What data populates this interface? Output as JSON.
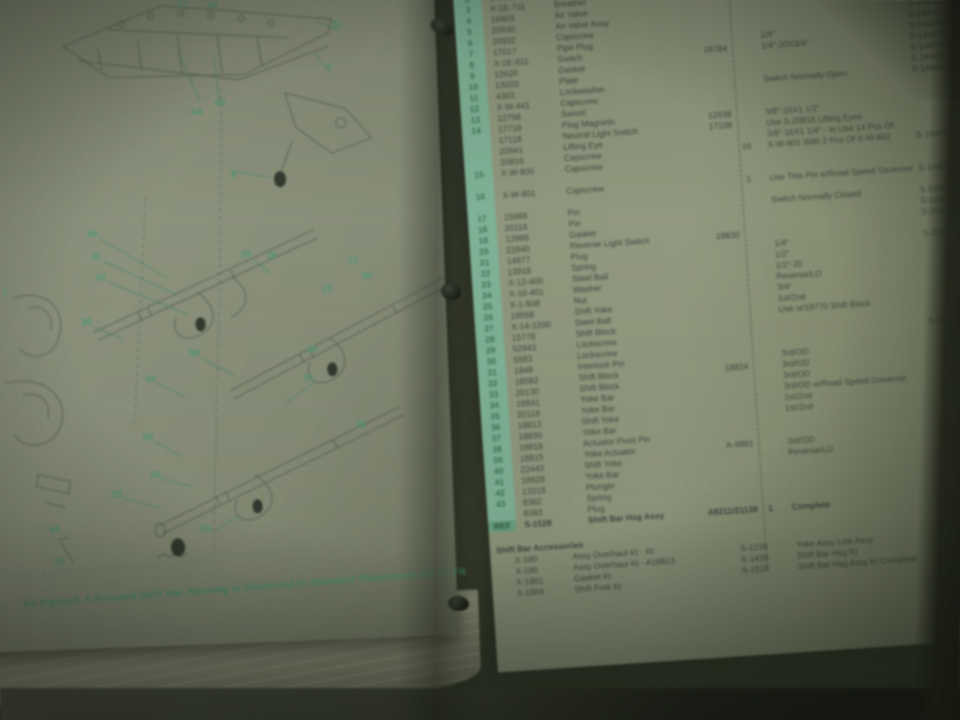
{
  "photo_subject": "Open ring binder showing a transmission shift bar housing parts manual",
  "colors": {
    "page": "#91997c",
    "background": "#343a2b",
    "mint_band": "#79bf9a",
    "accent_green": "#43a173",
    "ink": "#39443a"
  },
  "left_page": {
    "caption_small": "S-1528 CPL SHIFT BAR HOUSING ASSEMBLY",
    "caption_main": "As Figured: A Forward Shift Bar Housing Is Illustrated In Standard Placements Kit To Fit",
    "callouts": [
      [
        "1",
        38,
        34
      ],
      [
        "21",
        222,
        28
      ],
      [
        "24",
        252,
        30
      ],
      [
        "11",
        376,
        54
      ],
      [
        "4",
        366,
        96
      ],
      [
        "64",
        232,
        136
      ],
      [
        "63",
        256,
        128
      ],
      [
        "8",
        267,
        200
      ],
      [
        "7",
        34,
        310
      ],
      [
        "40",
        123,
        254
      ],
      [
        "41",
        126,
        277
      ],
      [
        "42",
        130,
        298
      ],
      [
        "20",
        276,
        280
      ],
      [
        "26",
        302,
        282
      ],
      [
        "27",
        356,
        318
      ],
      [
        "17",
        383,
        291
      ],
      [
        "36",
        396,
        306
      ],
      [
        "35",
        114,
        342
      ],
      [
        "38",
        220,
        377
      ],
      [
        "34",
        176,
        401
      ],
      [
        "30",
        338,
        378
      ],
      [
        "31",
        334,
        406
      ],
      [
        "29",
        171,
        459
      ],
      [
        "28",
        384,
        455
      ],
      [
        "33",
        177,
        497
      ],
      [
        "32",
        138,
        515
      ],
      [
        "25",
        225,
        553
      ],
      [
        "43",
        74,
        548
      ],
      [
        "23",
        78,
        580
      ]
    ]
  },
  "right_page": {
    "rows": [
      [
        "",
        "",
        "Shift Bar Hsg",
        "A8211/21138 Assy",
        "",
        "",
        ""
      ],
      [
        "1",
        "X-1-110",
        "Socket",
        "",
        "",
        "",
        "S-1528"
      ],
      [
        "2",
        "14012",
        "Pipe Plug",
        "18828",
        "",
        "1/4\"-20X1 1/2\"",
        "S-2081/S-1440/S-1528"
      ],
      [
        "3",
        "X-1E-711",
        "Breather",
        "14117",
        "",
        "3/8\"",
        "S-1440/S-1528"
      ],
      [
        "4",
        "16903",
        "Air Valve",
        "",
        "",
        "",
        "S-1440/S-1528"
      ],
      [
        "5",
        "20930",
        "Air Valve Assy",
        "",
        "",
        "",
        "S-1440/S-1528"
      ],
      [
        "6",
        "20932",
        "Capscrew",
        "",
        "",
        "",
        "S-1440/S-1528"
      ],
      [
        "7",
        "17017",
        "Pipe Plug",
        "",
        "",
        "1/4\"",
        "S-1440/S-1528"
      ],
      [
        "8",
        "X-1E-811",
        "Switch",
        "18784",
        "",
        "1/4\"-20X3/4\"",
        "S-1440/S-1528"
      ],
      [
        "9",
        "12620",
        "Gasket",
        "",
        "",
        "",
        "S-1440/S-1528"
      ],
      [
        "10",
        "13033",
        "Plate",
        "",
        "",
        "",
        "S-1440/S-1528"
      ],
      [
        "11",
        "4303",
        "Lockwasher",
        "",
        "",
        "Switch Normally Open",
        "S-1440/S-1528"
      ],
      [
        "12",
        "X-W-441",
        "Capscrew",
        "",
        "",
        "",
        ""
      ],
      [
        "13",
        "12798",
        "Swivel",
        "",
        "",
        "",
        ""
      ],
      [
        "14",
        "17718",
        "Plug Magnetic",
        "12638",
        "",
        "3/8\"-16X1 1/2\"",
        ""
      ],
      [
        "",
        "17118",
        "Neutral Light Switch",
        "17108",
        "",
        "Use S-20816 Lifting Eyes",
        ""
      ],
      [
        "",
        "20941",
        "Lifting Eye",
        "",
        "",
        "3/8\"-16X1 1/4\" - to Use 14 Pcs Of",
        ""
      ],
      [
        "",
        "20816",
        "Capscrew",
        "",
        "16",
        "X-W-801 With 2 Pcs Of X-W-802",
        "S-1440/S-1528"
      ],
      [
        "15",
        "X-W-800",
        "Capscrew",
        "",
        "",
        "",
        ""
      ],
      [
        "",
        "",
        "",
        "",
        "",
        "",
        ""
      ],
      [
        "16",
        "X-W-801",
        "Capscrew",
        "",
        "1",
        "Use This Pin w/Road Speed Governor",
        "S-1440/S-1528"
      ],
      [
        "",
        "",
        "",
        "",
        "",
        "",
        ""
      ],
      [
        "17",
        "15988",
        "Pin",
        "",
        "",
        "Switch Normally Closed",
        "S-1440/S-1528"
      ],
      [
        "18",
        "20118",
        "Pin",
        "",
        "",
        "",
        "S-1081/S-1440"
      ],
      [
        "19",
        "12988",
        "Gasket",
        "",
        "",
        "",
        "S-2084/S-1528"
      ],
      [
        "20",
        "22840",
        "Reverse Light Switch",
        "18830",
        "",
        "",
        "S-1528"
      ],
      [
        "21",
        "14877",
        "Plug",
        "",
        "",
        "1/4\"",
        "S-2084/S-1528"
      ],
      [
        "22",
        "13918",
        "Spring",
        "",
        "",
        "1/2\"",
        "S-1528"
      ],
      [
        "23",
        "X-12-400",
        "Steel Ball",
        "",
        "",
        "1/2\"-20",
        "S-1528"
      ],
      [
        "24",
        "X-10-401",
        "Washer",
        "",
        "",
        "Reverse/LO",
        "S-1528"
      ],
      [
        "25",
        "X-1-908",
        "Nut",
        "",
        "",
        "3/4\"",
        "S-1528"
      ],
      [
        "26",
        "19558",
        "Shift Yoke",
        "",
        "",
        "1st/2nd",
        "S-1528"
      ],
      [
        "27",
        "X-14-1200",
        "Steel Ball",
        "",
        "",
        "Use w/18770 Shift Block",
        "S-1528"
      ],
      [
        "28",
        "15778",
        "Shift Block",
        "",
        "",
        "",
        "S-1528"
      ],
      [
        "29",
        "52943",
        "Lockscrew",
        "",
        "",
        "",
        "S-2084/S-1528"
      ],
      [
        "30",
        "5593",
        "Lockscrew",
        "",
        "",
        "",
        "S-1528"
      ],
      [
        "31",
        "1849",
        "Interlock Pin",
        "",
        "",
        "3rd/OD",
        "S-1528"
      ],
      [
        "32",
        "18082",
        "Shift Block",
        "18824",
        "",
        "3rd/OD",
        "S-1528"
      ],
      [
        "33",
        "20130",
        "Shift Block",
        "",
        "",
        "3rd/OD",
        "S-1440"
      ],
      [
        "34",
        "18841",
        "Yoke Bar",
        "",
        "",
        "3rd/OD w/Road Speed Governor",
        "S-1440"
      ],
      [
        "35",
        "20118",
        "Yoke Bar",
        "",
        "",
        "1st/2nd",
        "S-1528"
      ],
      [
        "36",
        "18813",
        "Shift Yoke",
        "",
        "",
        "1st/2nd",
        "S-1440"
      ],
      [
        "37",
        "18830",
        "Yoke Bar",
        "",
        "",
        "",
        "S-1528"
      ],
      [
        "38",
        "18818",
        "Actuator Pivot Pin",
        "",
        "",
        "",
        ""
      ],
      [
        "39",
        "18815",
        "Yoke Actuator",
        "A-4881",
        "",
        "3rd/OD",
        ""
      ],
      [
        "40",
        "22443",
        "Shift Yoke",
        "",
        "",
        "Reverse/LO",
        ""
      ],
      [
        "41",
        "18828",
        "Yoke Bar",
        "",
        "",
        "",
        ""
      ],
      [
        "42",
        "13318",
        "Plunger",
        "",
        "",
        "",
        ""
      ],
      [
        "43",
        "8382",
        "Spring",
        "",
        "",
        "",
        ""
      ],
      [
        "",
        "8383",
        "Plug",
        "",
        "",
        "",
        ""
      ]
    ],
    "assembly_row": [
      "REF",
      "S-1528",
      "Shift Bar Hsg Assy",
      "A8211/21138",
      "1",
      "Complete",
      ""
    ],
    "accessories": {
      "title": "Shift Bar Accessories",
      "left_rows": [
        [
          "X-180",
          "Assy Overhaul Kt - Kt"
        ],
        [
          "X-186",
          "Assy Overhaul Kt - A18813"
        ],
        [
          "X-1901",
          "Gasket Kt"
        ],
        [
          "X-1904",
          "Shift Fork Kt"
        ]
      ],
      "right_rows": [
        [
          "S-1238",
          "Yoke Assy Link Assy"
        ],
        [
          "S-1438",
          "Shift Bar Hsg Kt"
        ],
        [
          "S-1528",
          "Shift Bar Hsg Assy Kt Complete"
        ]
      ]
    }
  }
}
